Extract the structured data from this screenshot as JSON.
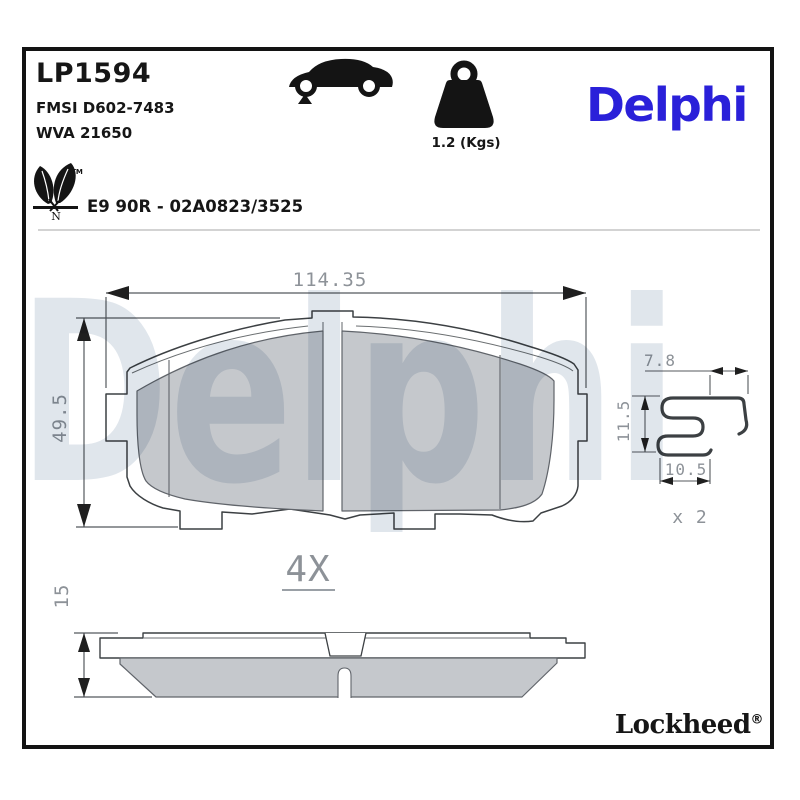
{
  "header": {
    "part_number": "LP1594",
    "fmsi_ref": "FMSI D602-7483",
    "wva_ref": "WVA 21650",
    "homologation": "E9 90R - 02A0823/3525",
    "weight_label": "1.2 (Kgs)",
    "brand_logo": "Delphi",
    "leaf_trademark": "TM",
    "leaf_letter": "N"
  },
  "drawing": {
    "front_view": {
      "width_mm": "114.35",
      "height_mm": "49.5"
    },
    "side_view": {
      "thickness_mm": "15"
    },
    "set_quantity_label": "4X",
    "clip_view": {
      "width_top_mm": "7.8",
      "height_mm": "11.5",
      "width_bottom_mm": "10.5",
      "quantity_label": "x 2"
    }
  },
  "footer": {
    "brand": "Lockheed",
    "registered_mark": "®"
  },
  "watermark_text": "Delphi",
  "colors": {
    "brand_blue": "#2a20d9",
    "friction_gray": "#c5c8cc",
    "dimension_text": "#8d9298",
    "watermark": "#e0e6ec",
    "line_dark": "#3c4043"
  }
}
